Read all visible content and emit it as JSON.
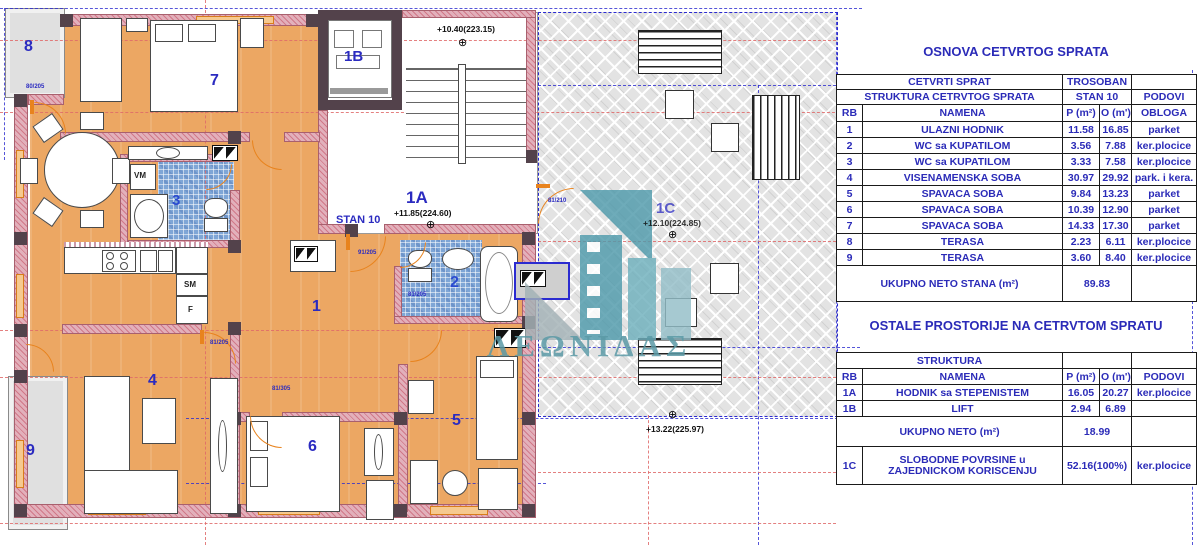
{
  "plan": {
    "stan": "STAN 10",
    "labels": {
      "t8": "8",
      "b7": "7",
      "lift": "1B",
      "bath3": "3",
      "hall1a": "1A",
      "terrace1c": "1C",
      "hall1": "1",
      "bath2": "2",
      "living4": "4",
      "t9": "9",
      "bed6": "6",
      "bed5": "5"
    },
    "elevations": {
      "stair": "+10.40(223.15)",
      "hall": "+11.85(224.60)",
      "terrace": "+12.10(224.85)",
      "lower": "+13.22(225.97)"
    },
    "appliances": {
      "vm": "VM",
      "sm": "SM",
      "f": "F"
    },
    "dims": {
      "d1": "91/205",
      "d2": "81/205",
      "d3": "81/210",
      "d4": "81/205",
      "d5": "80/205",
      "d6": "81/305"
    },
    "watermark": "ΛΕΩΝΙΔΑΣ"
  },
  "icons": {
    "marker": "⊕"
  },
  "section1": {
    "title": "OSNOVA CETVRTOG SPRATA",
    "header": {
      "left": "CETVRTI SPRAT",
      "left2": "STRUKTURA CETRVTOG SPRATA",
      "right": "TROSOBAN",
      "right2": "STAN 10",
      "podovi": "PODOVI",
      "rb": "RB",
      "namena": "NAMENA",
      "p": "P (m²)",
      "o": "O (m')",
      "obloga": "OBLOGA"
    },
    "rows": [
      {
        "rb": "1",
        "namena": "ULAZNI HODNIK",
        "p": "11.58",
        "o": "16.85",
        "pod": "parket"
      },
      {
        "rb": "2",
        "namena": "WC sa KUPATILOM",
        "p": "3.56",
        "o": "7.88",
        "pod": "ker.plocice"
      },
      {
        "rb": "3",
        "namena": "WC sa KUPATILOM",
        "p": "3.33",
        "o": "7.58",
        "pod": "ker.plocice"
      },
      {
        "rb": "4",
        "namena": "VISENAMENSKA SOBA",
        "p": "30.97",
        "o": "29.92",
        "pod": "park. i kera."
      },
      {
        "rb": "5",
        "namena": "SPAVACA SOBA",
        "p": "9.84",
        "o": "13.23",
        "pod": "parket"
      },
      {
        "rb": "6",
        "namena": "SPAVACA SOBA",
        "p": "10.39",
        "o": "12.90",
        "pod": "parket"
      },
      {
        "rb": "7",
        "namena": "SPAVACA SOBA",
        "p": "14.33",
        "o": "17.30",
        "pod": "parket"
      },
      {
        "rb": "8",
        "namena": "TERASA",
        "p": "2.23",
        "o": "6.11",
        "pod": "ker.plocice"
      },
      {
        "rb": "9",
        "namena": "TERASA",
        "p": "3.60",
        "o": "8.40",
        "pod": "ker.plocice"
      }
    ],
    "total_label": "UKUPNO NETO STANA (m²)",
    "total_value": "89.83"
  },
  "section2": {
    "title": "OSTALE PROSTORIJE NA CETRVTOM SPRATU",
    "struktura": "STRUKTURA",
    "rb": "RB",
    "namena": "NAMENA",
    "p": "P (m²)",
    "o": "O (m')",
    "podovi": "PODOVI",
    "rows": [
      {
        "rb": "1A",
        "namena": "HODNIK sa STEPENISTEM",
        "p": "16.05",
        "o": "20.27",
        "pod": "ker.plocice"
      },
      {
        "rb": "1B",
        "namena": "LIFT",
        "p": "2.94",
        "o": "6.89",
        "pod": ""
      }
    ],
    "total_label": "UKUPNO NETO (m²)",
    "total_value": "18.99",
    "row1c": {
      "rb": "1C",
      "namena": "SLOBODNE POVRSINE u ZAJEDNICKOM KORISCENJU",
      "value": "52.16(100%)",
      "pod": "ker.plocice"
    }
  }
}
